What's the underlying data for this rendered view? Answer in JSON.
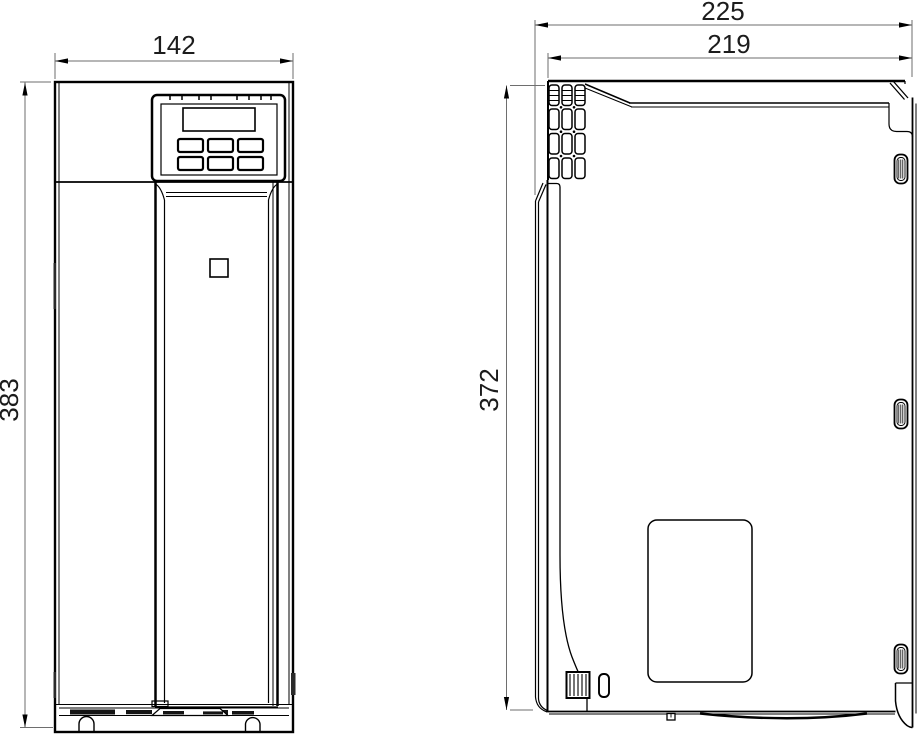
{
  "figure": {
    "type": "technical-dimension-drawing",
    "views": {
      "front": {
        "dims": {
          "width": "142",
          "height": "383"
        }
      },
      "side": {
        "dims": {
          "depth_overall": "225",
          "depth_body": "219",
          "height": "372"
        }
      }
    }
  },
  "colors": {
    "line": "#000000",
    "dimension_line": "#6e6e6e",
    "background": "#ffffff"
  }
}
